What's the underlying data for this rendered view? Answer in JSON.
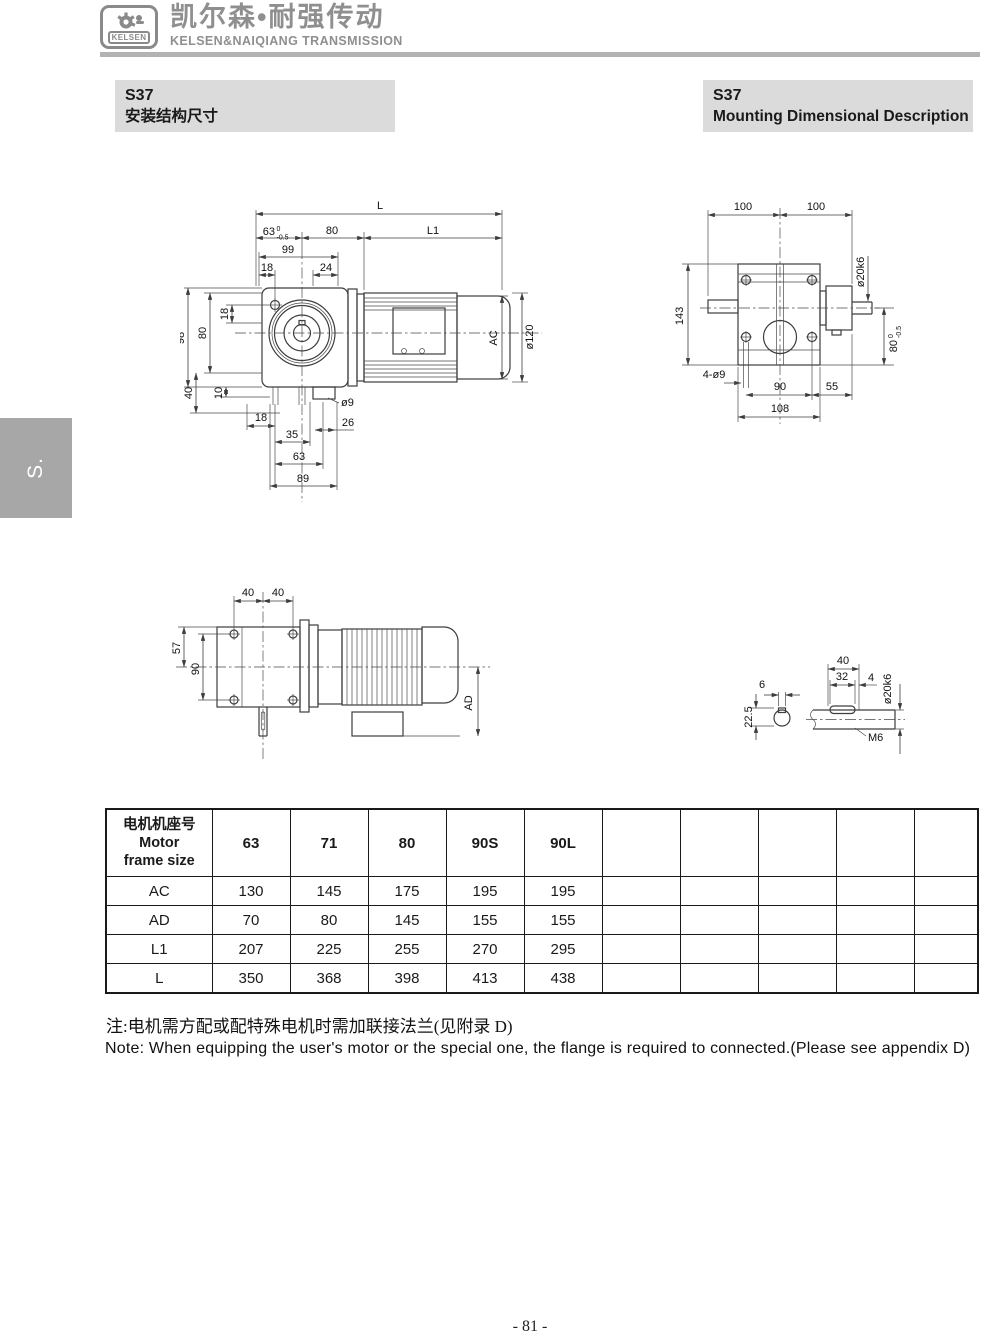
{
  "header": {
    "logo_badge": "KELSEN",
    "brand_cn": "凯尔森•耐强传动",
    "brand_en": "KELSEN&NAIQIANG TRANSMISSION"
  },
  "side_tab": {
    "label": "S."
  },
  "section_titles": {
    "left": {
      "model": "S37",
      "subtitle": "安装结构尺寸"
    },
    "right": {
      "model": "S37",
      "subtitle": "Mounting Dimensional Description"
    }
  },
  "drawings": {
    "front": {
      "L": "L",
      "tol63": "63",
      "tol63_up": "0",
      "tol63_dn": "-0.5",
      "d80_top": "80",
      "L1": "L1",
      "d99": "99",
      "d18_top": "18",
      "d24": "24",
      "d98": "98",
      "d80_left": "80",
      "d18_left": "18",
      "d40_left": "40",
      "d10_left": "10",
      "d18_bot": "18",
      "d35": "35",
      "d63_bot": "63",
      "d89": "89",
      "dia9": "ø9",
      "d26": "26",
      "AC": "AC",
      "dia120": "ø120"
    },
    "rear": {
      "d100_l": "100",
      "d100_r": "100",
      "d143": "143",
      "dia20k6": "ø20k6",
      "tol80": "80",
      "tol80_up": "0",
      "tol80_dn": "-0.5",
      "holes": "4-ø9",
      "d90": "90",
      "d55": "55",
      "d108": "108"
    },
    "side": {
      "d40_l": "40",
      "d40_r": "40",
      "d57": "57",
      "d90": "90",
      "AD": "AD"
    },
    "shaft": {
      "d6": "6",
      "d22_5": "22.5",
      "d40": "40",
      "d32": "32",
      "d4": "4",
      "dia20k6": "ø20k6",
      "m6": "M6"
    }
  },
  "table": {
    "col_header": {
      "cn": "电机机座号",
      "en_line1": "Motor",
      "en_line2": "frame size"
    },
    "frame_sizes": [
      "63",
      "71",
      "80",
      "90S",
      "90L"
    ],
    "rows": [
      {
        "label": "AC",
        "values": [
          "130",
          "145",
          "175",
          "195",
          "195"
        ]
      },
      {
        "label": "AD",
        "values": [
          "70",
          "80",
          "145",
          "155",
          "155"
        ]
      },
      {
        "label": "L1",
        "values": [
          "207",
          "225",
          "255",
          "270",
          "295"
        ]
      },
      {
        "label": "L",
        "values": [
          "350",
          "368",
          "398",
          "413",
          "438"
        ]
      }
    ]
  },
  "notes": {
    "cn": "注:电机需方配或配特殊电机时需加联接法兰(见附录 D)",
    "en": "Note: When equipping the user's motor or the special one, the flange is required to connected.(Please see appendix D)"
  },
  "footer": {
    "page_number": "- 81 -"
  }
}
